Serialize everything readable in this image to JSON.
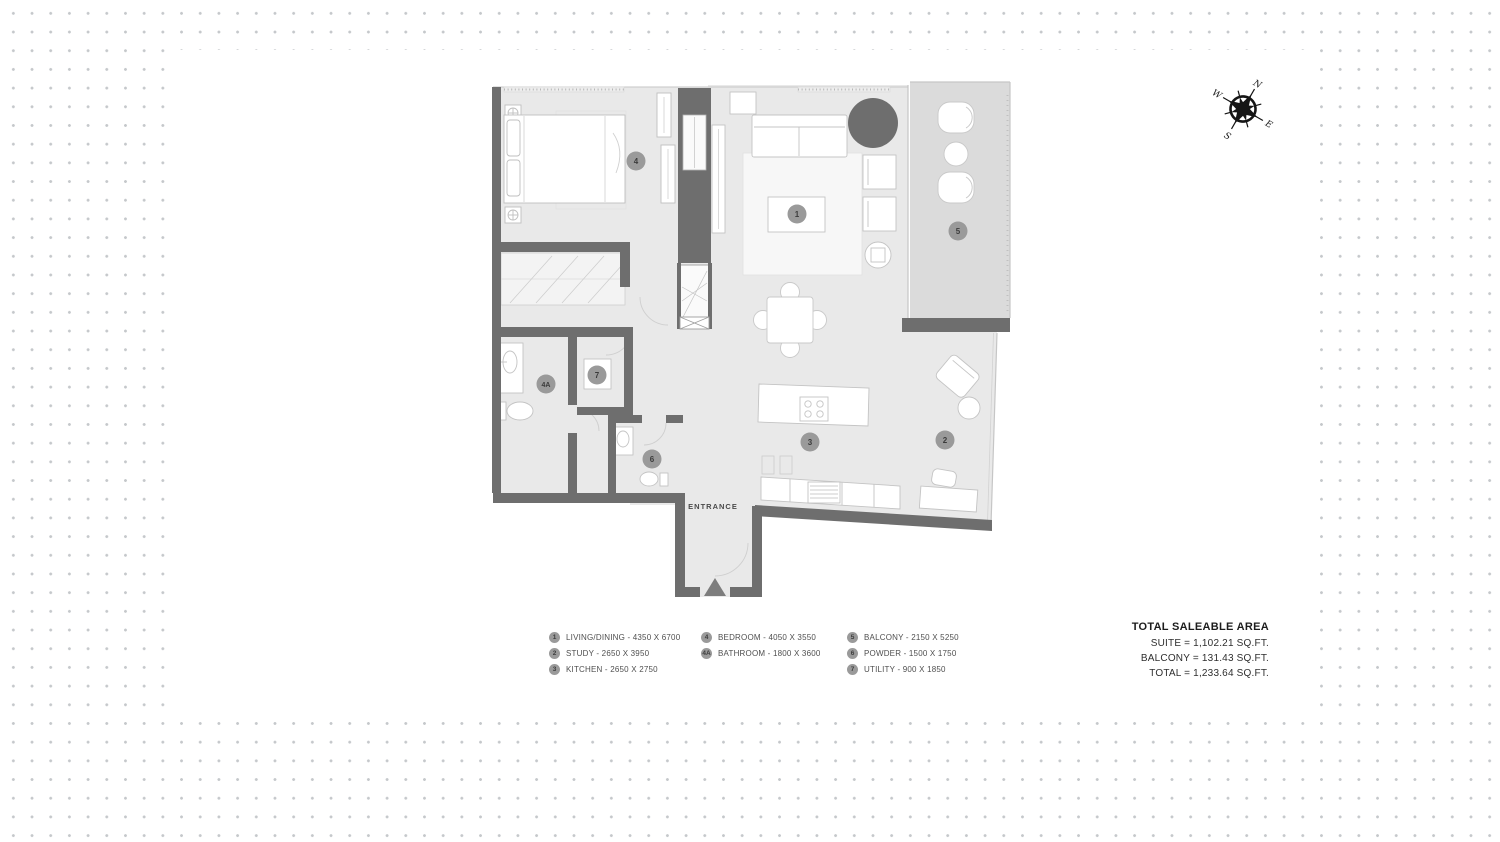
{
  "colors": {
    "wall": "#6e6e6e",
    "floor": "#e9e9e9",
    "balcony_floor": "#dbdbdb",
    "marker": "#9a9a9a",
    "dark_circle": "#6e6e6e",
    "dot_grid": "#c5c8cb"
  },
  "plan": {
    "entrance_label": "ENTRANCE",
    "markers": {
      "m1": "1",
      "m2": "2",
      "m3": "3",
      "m4": "4",
      "m4a": "4A",
      "m5": "5",
      "m6": "6",
      "m7": "7"
    }
  },
  "legend": {
    "items": [
      {
        "marker": "1",
        "label": "LIVING/DINING - 4350 X 6700"
      },
      {
        "marker": "2",
        "label": "STUDY - 2650 X 3950"
      },
      {
        "marker": "3",
        "label": "KITCHEN - 2650 X 2750"
      },
      {
        "marker": "4",
        "label": "BEDROOM - 4050 X 3550"
      },
      {
        "marker": "4A",
        "label": "BATHROOM - 1800 X 3600"
      },
      {
        "marker": "5",
        "label": "BALCONY - 2150 X 5250"
      },
      {
        "marker": "6",
        "label": "POWDER - 1500 X 1750"
      },
      {
        "marker": "7",
        "label": "UTILITY - 900 X 1850"
      }
    ]
  },
  "areas": {
    "title": "TOTAL SALEABLE AREA",
    "suite": "SUITE = 1,102.21 SQ.FT.",
    "balcony": "BALCONY = 131.43 SQ.FT.",
    "total": "TOTAL = 1,233.64 SQ.FT."
  },
  "compass": {
    "north": "N",
    "east": "E",
    "south": "S",
    "west": "W"
  }
}
